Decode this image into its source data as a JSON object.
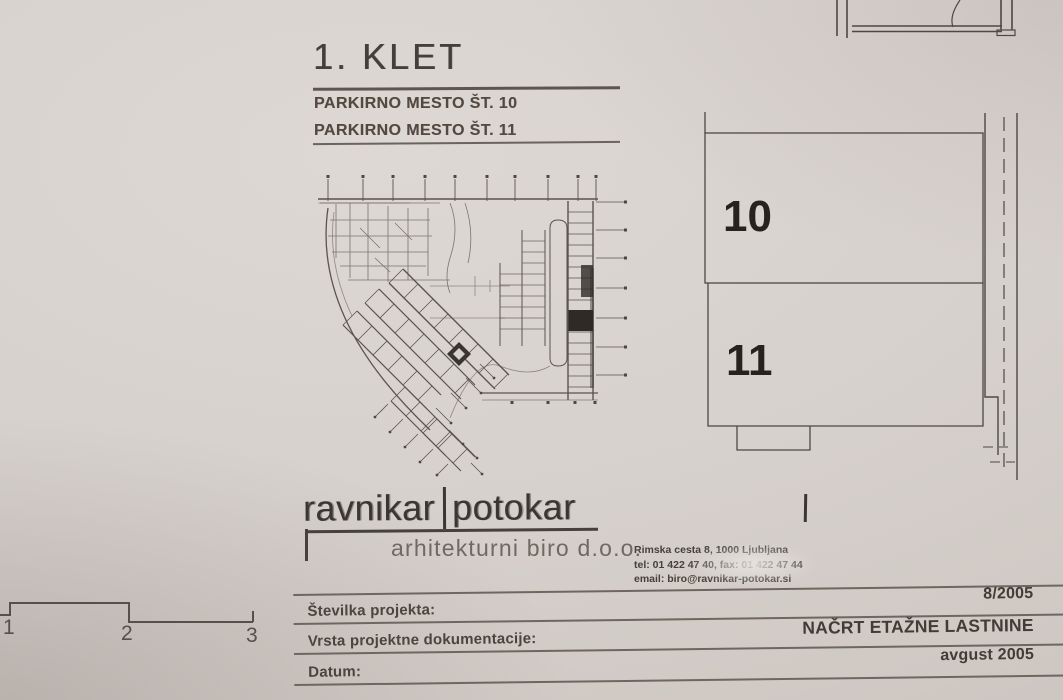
{
  "page": {
    "paper_color": "#d7d1cd",
    "ink_color": "#4a443e",
    "highlight_fill": "#2e2a25"
  },
  "header": {
    "title": "1. KLET",
    "subtitle_1": "PARKIRNO MESTO ŠT. 10",
    "subtitle_2": "PARKIRNO MESTO ŠT. 11"
  },
  "detail": {
    "spaces": [
      {
        "number": "10"
      },
      {
        "number": "11"
      }
    ]
  },
  "logo": {
    "name_left": "ravnikar",
    "name_right": "potokar",
    "subtitle": "arhitekturni biro d.o.o.",
    "address_line": "Rimska cesta 8, 1000 Ljubljana",
    "phone_line": "tel: 01 422 47 40, fax: 01 422 47 44",
    "email_line": "email: biro@ravnikar-potokar.si"
  },
  "titleblock": {
    "rows": [
      {
        "label": "Številka projekta:",
        "value": "8/2005"
      },
      {
        "label": "Vrsta projektne dokumentacije:",
        "value": "NAČRT ETAŽNE LASTNINE"
      },
      {
        "label": "Datum:",
        "value": "avgust 2005"
      }
    ]
  },
  "scalebar": {
    "labels": [
      "1",
      "2",
      "3"
    ]
  }
}
